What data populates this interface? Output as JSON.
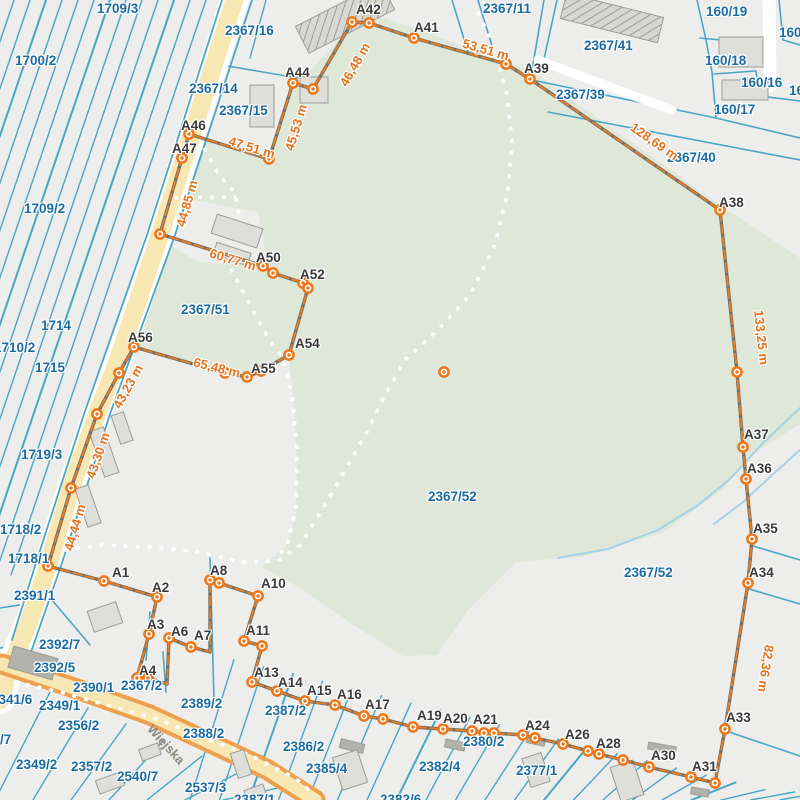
{
  "map": {
    "type": "cadastral-parcel-map",
    "colors": {
      "background": "#ededeb",
      "parcel_line": "#4aa6c6",
      "parcel_label": "#1a6ca3",
      "boundary_gray": "#70706a",
      "boundary_orange": "#ec7d1f",
      "marker_orange": "#ee7618",
      "point_label": "#3a3a3a",
      "distance_label": "#e4731c",
      "green_area": "#dfe7d8",
      "road_fill": "#f7e7b3",
      "road_casing_orange": "#eda14f",
      "building_fill": "#dededa",
      "stream": "#a5d2e6"
    },
    "street": {
      "name": "Wiejska",
      "x": 150,
      "y": 719,
      "rot": 48
    },
    "parcel_labels": [
      {
        "t": "1709/3",
        "x": 97,
        "y": 1
      },
      {
        "t": "2367/16",
        "x": 225,
        "y": 23
      },
      {
        "t": "2367/11",
        "x": 483,
        "y": 1
      },
      {
        "t": "160/19",
        "x": 706,
        "y": 4
      },
      {
        "t": "160/18",
        "x": 779,
        "y": 25
      },
      {
        "t": "1700/2",
        "x": 15,
        "y": 53
      },
      {
        "t": "2367/41",
        "x": 584,
        "y": 38
      },
      {
        "t": "160/18",
        "x": 705,
        "y": 53
      },
      {
        "t": "2367/14",
        "x": 189,
        "y": 81
      },
      {
        "t": "160/16",
        "x": 741,
        "y": 75
      },
      {
        "t": "160/16",
        "x": 789,
        "y": 83
      },
      {
        "t": "2367/15",
        "x": 219,
        "y": 103
      },
      {
        "t": "2367/39",
        "x": 556,
        "y": 87
      },
      {
        "t": "160/17",
        "x": 714,
        "y": 102
      },
      {
        "t": "2367/40",
        "x": 667,
        "y": 150
      },
      {
        "t": "1709/2",
        "x": 24,
        "y": 201
      },
      {
        "t": "2367/51",
        "x": 181,
        "y": 302
      },
      {
        "t": "1714",
        "x": 41,
        "y": 318
      },
      {
        "t": "1710/2",
        "x": -6,
        "y": 340
      },
      {
        "t": "1715",
        "x": 35,
        "y": 360
      },
      {
        "t": "1719/3",
        "x": 21,
        "y": 447
      },
      {
        "t": "2367/52",
        "x": 428,
        "y": 489
      },
      {
        "t": "2367/52",
        "x": 624,
        "y": 565
      },
      {
        "t": "1718/2",
        "x": 0,
        "y": 522
      },
      {
        "t": "1718/1",
        "x": 8,
        "y": 551
      },
      {
        "t": "2391/1",
        "x": 14,
        "y": 588
      },
      {
        "t": "2392/7",
        "x": 39,
        "y": 637
      },
      {
        "t": "2392/5",
        "x": 34,
        "y": 660
      },
      {
        "t": "2390/1",
        "x": 73,
        "y": 680
      },
      {
        "t": "2367/2",
        "x": 121,
        "y": 678
      },
      {
        "t": "2341/6",
        "x": -9,
        "y": 692
      },
      {
        "t": "2349/1",
        "x": 39,
        "y": 698
      },
      {
        "t": "2389/2",
        "x": 181,
        "y": 696
      },
      {
        "t": "2356/2",
        "x": 58,
        "y": 718
      },
      {
        "t": "/7",
        "x": 0,
        "y": 732
      },
      {
        "t": "2349/2",
        "x": 16,
        "y": 757
      },
      {
        "t": "2357/2",
        "x": 71,
        "y": 759
      },
      {
        "t": "2540/7",
        "x": 117,
        "y": 769
      },
      {
        "t": "2537/3",
        "x": 185,
        "y": 780
      },
      {
        "t": "2387/2",
        "x": 265,
        "y": 703
      },
      {
        "t": "2388/2",
        "x": 183,
        "y": 726
      },
      {
        "t": "2386/2",
        "x": 283,
        "y": 739
      },
      {
        "t": "2385/4",
        "x": 306,
        "y": 761
      },
      {
        "t": "2382/4",
        "x": 419,
        "y": 759
      },
      {
        "t": "2380/2",
        "x": 463,
        "y": 734
      },
      {
        "t": "2377/1",
        "x": 516,
        "y": 763
      },
      {
        "t": "2382/6",
        "x": 380,
        "y": 792
      },
      {
        "t": "2387/1",
        "x": 234,
        "y": 792
      }
    ],
    "distance_labels": [
      {
        "t": "46,48 m",
        "x": 331,
        "y": 57,
        "r": -60
      },
      {
        "t": "53,51 m",
        "x": 462,
        "y": 42,
        "r": 16
      },
      {
        "t": "128,69 m",
        "x": 627,
        "y": 134,
        "r": 35
      },
      {
        "t": "133,25 m",
        "x": 734,
        "y": 330,
        "r": 84
      },
      {
        "t": "82,36 m",
        "x": 742,
        "y": 661,
        "r": 99
      },
      {
        "t": "45,53 m",
        "x": 272,
        "y": 120,
        "r": -73
      },
      {
        "t": "47,51 m",
        "x": 228,
        "y": 140,
        "r": 17
      },
      {
        "t": "44,85 m",
        "x": 163,
        "y": 196,
        "r": -74
      },
      {
        "t": "60,77 m",
        "x": 209,
        "y": 252,
        "r": 17
      },
      {
        "t": "65,48 m",
        "x": 193,
        "y": 360,
        "r": 14
      },
      {
        "t": "43,23 m",
        "x": 104,
        "y": 379,
        "r": -61
      },
      {
        "t": "43,30 m",
        "x": 74,
        "y": 448,
        "r": -71
      },
      {
        "t": "44,44 m",
        "x": 51,
        "y": 520,
        "r": -74
      }
    ],
    "point_labels": [
      {
        "t": "A1",
        "x": 112,
        "y": 565
      },
      {
        "t": "A2",
        "x": 152,
        "y": 580
      },
      {
        "t": "A3",
        "x": 147,
        "y": 617
      },
      {
        "t": "A4",
        "x": 139,
        "y": 663
      },
      {
        "t": "A6",
        "x": 171,
        "y": 624
      },
      {
        "t": "A7",
        "x": 194,
        "y": 628
      },
      {
        "t": "A8",
        "x": 210,
        "y": 563
      },
      {
        "t": "A10",
        "x": 261,
        "y": 576
      },
      {
        "t": "A11",
        "x": 246,
        "y": 623
      },
      {
        "t": "A13",
        "x": 254,
        "y": 665
      },
      {
        "t": "A14",
        "x": 278,
        "y": 675
      },
      {
        "t": "A15",
        "x": 307,
        "y": 683
      },
      {
        "t": "A16",
        "x": 337,
        "y": 687
      },
      {
        "t": "A17",
        "x": 365,
        "y": 697
      },
      {
        "t": "A19",
        "x": 417,
        "y": 708
      },
      {
        "t": "A20",
        "x": 443,
        "y": 711
      },
      {
        "t": "A21",
        "x": 473,
        "y": 712
      },
      {
        "t": "A24",
        "x": 525,
        "y": 718
      },
      {
        "t": "A26",
        "x": 565,
        "y": 727
      },
      {
        "t": "A28",
        "x": 596,
        "y": 736
      },
      {
        "t": "A30",
        "x": 651,
        "y": 748
      },
      {
        "t": "A31",
        "x": 692,
        "y": 759
      },
      {
        "t": "A33",
        "x": 726,
        "y": 710
      },
      {
        "t": "A34",
        "x": 749,
        "y": 565
      },
      {
        "t": "A35",
        "x": 753,
        "y": 521
      },
      {
        "t": "A36",
        "x": 747,
        "y": 461
      },
      {
        "t": "A37",
        "x": 744,
        "y": 427
      },
      {
        "t": "A38",
        "x": 719,
        "y": 195
      },
      {
        "t": "A39",
        "x": 524,
        "y": 61
      },
      {
        "t": "A41",
        "x": 414,
        "y": 20
      },
      {
        "t": "A42",
        "x": 356,
        "y": 2
      },
      {
        "t": "A44",
        "x": 285,
        "y": 65
      },
      {
        "t": "A46",
        "x": 181,
        "y": 118
      },
      {
        "t": "A47",
        "x": 172,
        "y": 141
      },
      {
        "t": "A50",
        "x": 256,
        "y": 250
      },
      {
        "t": "A52",
        "x": 300,
        "y": 267
      },
      {
        "t": "A54",
        "x": 295,
        "y": 336
      },
      {
        "t": "A55",
        "x": 251,
        "y": 361
      },
      {
        "t": "A56",
        "x": 128,
        "y": 330
      }
    ],
    "boundary": {
      "closed": true,
      "vertices": [
        [
          48,
          566,
          1
        ],
        [
          104,
          581,
          1
        ],
        [
          157,
          597,
          1
        ],
        [
          149,
          634,
          1
        ],
        [
          137,
          678,
          1
        ],
        [
          148,
          678,
          1
        ],
        [
          167,
          684,
          0
        ],
        [
          169,
          638,
          1
        ],
        [
          191,
          647,
          1
        ],
        [
          210,
          652,
          0
        ],
        [
          210,
          580,
          1
        ],
        [
          219,
          583,
          1
        ],
        [
          258,
          596,
          1
        ],
        [
          244,
          641,
          1
        ],
        [
          262,
          646,
          1
        ],
        [
          252,
          682,
          1
        ],
        [
          277,
          691,
          1
        ],
        [
          305,
          701,
          1
        ],
        [
          335,
          705,
          1
        ],
        [
          364,
          716,
          1
        ],
        [
          383,
          719,
          1
        ],
        [
          413,
          727,
          1
        ],
        [
          443,
          729,
          1
        ],
        [
          472,
          731,
          1
        ],
        [
          484,
          733,
          1
        ],
        [
          494,
          733,
          1
        ],
        [
          523,
          735,
          1
        ],
        [
          535,
          738,
          1
        ],
        [
          563,
          744,
          1
        ],
        [
          588,
          751,
          1
        ],
        [
          599,
          754,
          1
        ],
        [
          623,
          760,
          1
        ],
        [
          649,
          767,
          1
        ],
        [
          691,
          777,
          1
        ],
        [
          715,
          783,
          1
        ],
        [
          725,
          729,
          1
        ],
        [
          748,
          583,
          1
        ],
        [
          752,
          539,
          1
        ],
        [
          746,
          479,
          1
        ],
        [
          743,
          447,
          1
        ],
        [
          737,
          372,
          1
        ],
        [
          720,
          210,
          1
        ],
        [
          530,
          79,
          1
        ],
        [
          506,
          64,
          1
        ],
        [
          414,
          38,
          1
        ],
        [
          369,
          23,
          1
        ],
        [
          352,
          22,
          1
        ],
        [
          313,
          89,
          1
        ],
        [
          293,
          83,
          1
        ],
        [
          269,
          159,
          1
        ],
        [
          189,
          134,
          1
        ],
        [
          182,
          158,
          1
        ],
        [
          160,
          234,
          1
        ],
        [
          263,
          266,
          1
        ],
        [
          273,
          273,
          1
        ],
        [
          303,
          283,
          1
        ],
        [
          308,
          288,
          1
        ],
        [
          289,
          355,
          1
        ],
        [
          261,
          371,
          1
        ],
        [
          247,
          377,
          1
        ],
        [
          225,
          373,
          1
        ],
        [
          134,
          347,
          1
        ],
        [
          119,
          373,
          1
        ],
        [
          97,
          414,
          1
        ],
        [
          71,
          488,
          1
        ]
      ]
    },
    "isolated_points": [
      [
        444,
        372
      ]
    ]
  }
}
